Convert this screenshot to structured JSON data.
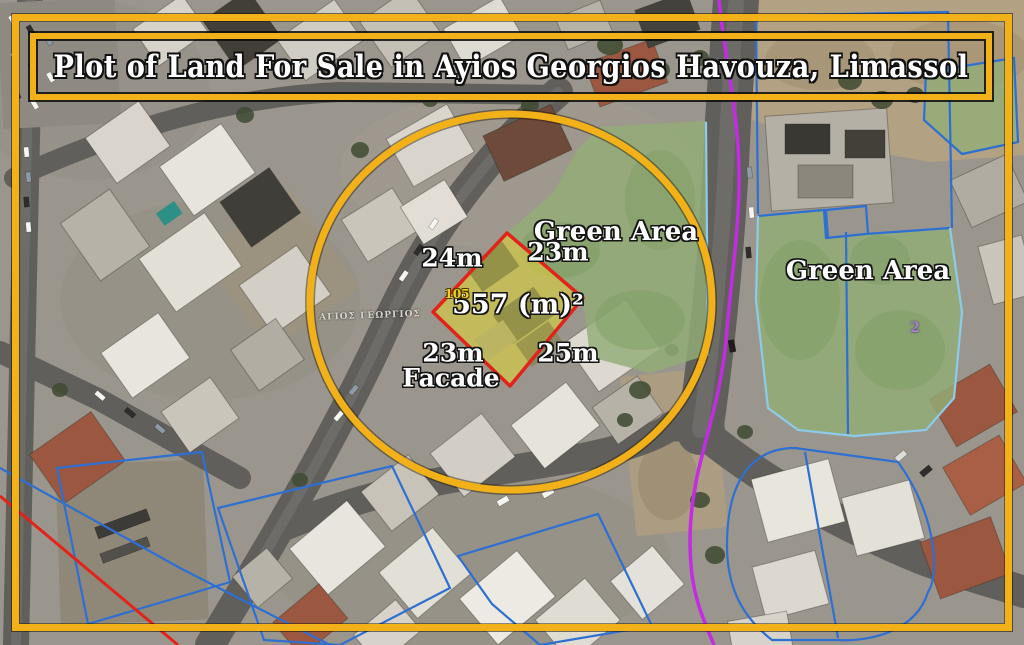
{
  "title_banner": {
    "text": "Plot of Land For Sale in Ayios Georgios Havouza, Limassol"
  },
  "plot": {
    "area_label": "557 (m)²",
    "plot_number": "105",
    "dim_top_left": "24m",
    "dim_top_right": "23m",
    "dim_bottom_right": "25m",
    "dim_bottom_left": "23m",
    "facade_label": "Facade"
  },
  "map_labels": {
    "green_area_inner": "Green Area",
    "green_area_right": "Green Area",
    "street_name": "ΑΓΙΟΣ ΓΕΩΡΓΙΟΣ",
    "parcel_number": "2"
  },
  "colors": {
    "highlight_yellow": "#F2B119",
    "plot_outline_red": "#E0241C",
    "plot_fill_yellow": "#E8DC2E",
    "green_overlay": "#92AD76",
    "cadastral_blue": "#2E6FD2",
    "cadastral_cyan": "#8CCBE9",
    "boundary_magenta": "#C32CE2",
    "boundary_red": "#E2231A",
    "label_text": "#FFFFFF"
  }
}
